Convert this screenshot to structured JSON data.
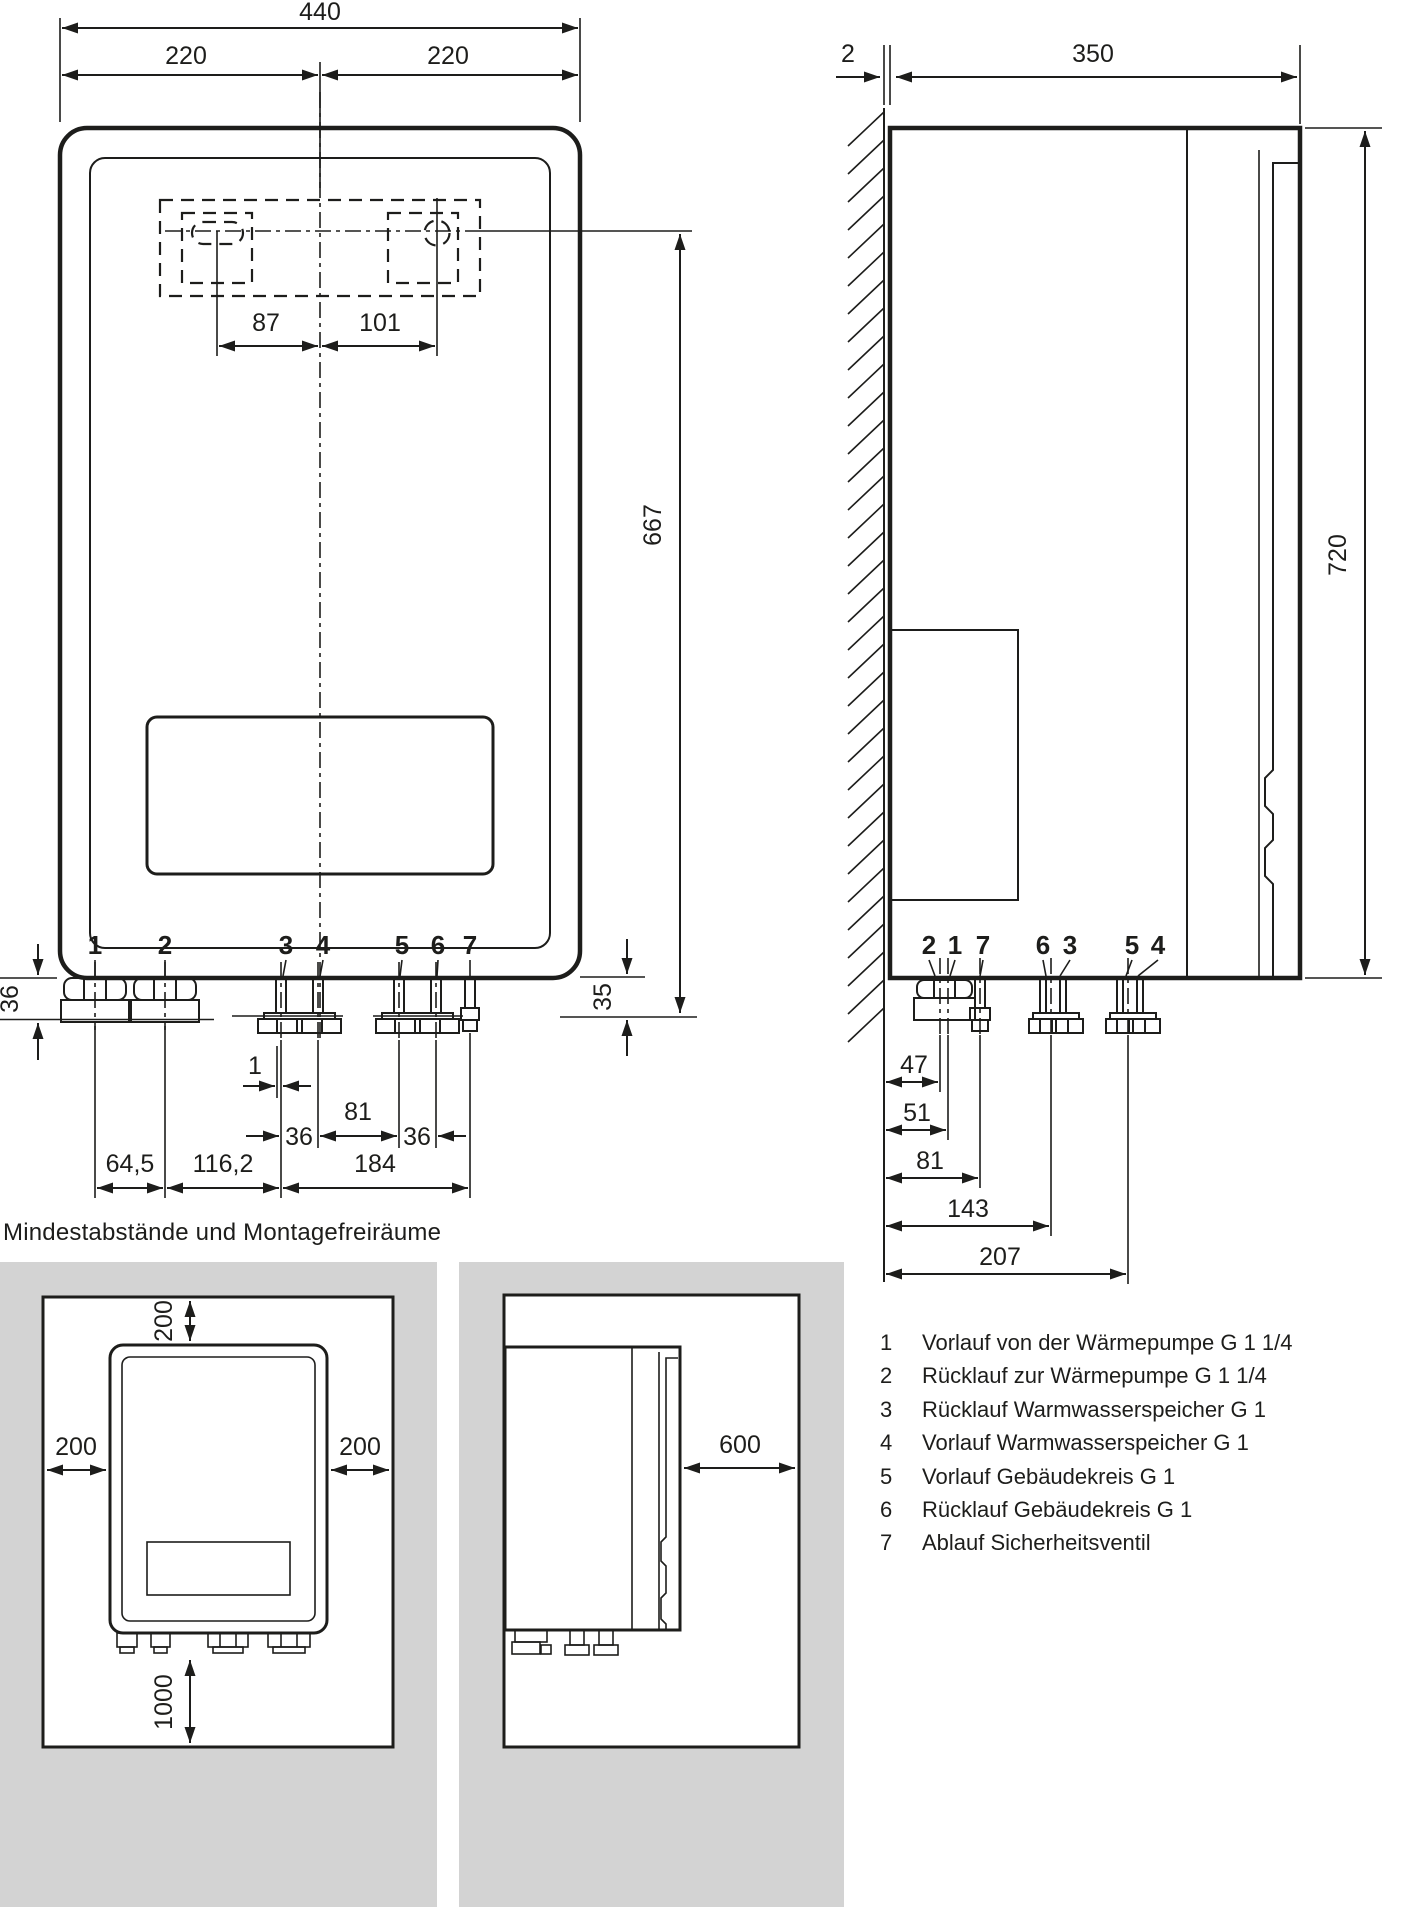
{
  "heading": "Mindestabstände und Montagefreiräume",
  "front_view": {
    "dims": {
      "total_width": "440",
      "half_left": "220",
      "half_right": "220",
      "hole_left": "87",
      "hole_right": "101",
      "height_holes_to_base": "667",
      "left_drop": "36",
      "right_drop": "35",
      "conn_offset_small": "1",
      "conn_36a": "36",
      "conn_81": "81",
      "conn_36b": "36",
      "span_1_2": "64,5",
      "span_2_3": "116,2",
      "span_3_7": "184"
    },
    "connection_labels": [
      "1",
      "2",
      "3",
      "4",
      "5",
      "6",
      "7"
    ]
  },
  "side_view": {
    "dims": {
      "wall_gap": "2",
      "depth": "350",
      "height": "720",
      "d47": "47",
      "d51": "51",
      "d81": "81",
      "d143": "143",
      "d207": "207"
    },
    "connection_labels": [
      "2",
      "1",
      "7",
      "6",
      "3",
      "5",
      "4"
    ]
  },
  "clearance": {
    "front": {
      "top": "200",
      "left": "200",
      "right": "200",
      "bottom": "1000"
    },
    "side": {
      "front": "600"
    }
  },
  "legend": {
    "items": [
      {
        "num": "1",
        "text": "Vorlauf von der Wärmepumpe G 1 1/4"
      },
      {
        "num": "2",
        "text": "Rücklauf zur Wärmepumpe G 1 1/4"
      },
      {
        "num": "3",
        "text": "Rücklauf Warmwasserspeicher G 1"
      },
      {
        "num": "4",
        "text": "Vorlauf Warmwasserspeicher G 1"
      },
      {
        "num": "5",
        "text": "Vorlauf Gebäudekreis G 1"
      },
      {
        "num": "6",
        "text": "Rücklauf Gebäudekreis G 1"
      },
      {
        "num": "7",
        "text": "Ablauf Sicherheitsventil"
      }
    ]
  },
  "colors": {
    "line": "#1d1d1b",
    "panel_gray": "#d3d3d3",
    "background": "#ffffff"
  }
}
